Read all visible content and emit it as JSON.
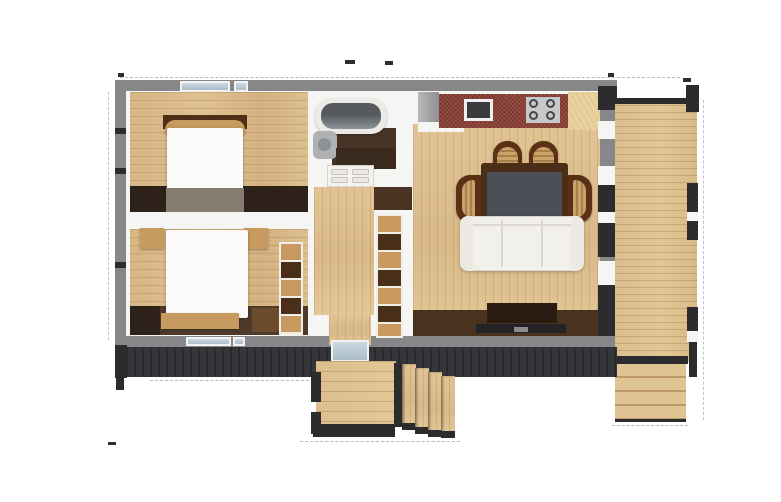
{
  "scene": {
    "type": "3d-floor-plan-render",
    "background": "#ffffff",
    "text_visible": false,
    "annotations": {
      "dimension_tick_marks": true,
      "tick_text_legible": false
    }
  },
  "palette": {
    "wall_gray": "#87878a",
    "wall_dark": "#2c2c2f",
    "siding_dark": "#34363a",
    "glass_blue": "#a9bcc9",
    "brick_red": "#8c4136",
    "shelf_wood": "#c89a62",
    "shelf_dark": "#4a2f1a",
    "duvet_white": "#fbfaf8",
    "tan_wood": "#c79a5f",
    "tub_rim": "#eceae7",
    "tub_gray": "#56595d",
    "chair_brown": "#5a3115",
    "chair_seat_tan": "#caa36b",
    "sofa_cream": "#f2f0ea",
    "table_gray": "#4c5056",
    "table_brown": "#4a2f16",
    "console_brown": "#2a1c10",
    "tv_black": "#232327",
    "floor_dark_brown": "#4e3a29",
    "floor_deep_brown": "#2e211a",
    "under_bed_gray": "#877c70",
    "wood_light": "#e0c192",
    "wood_deck": "#dcbe8e"
  },
  "rooms": [
    {
      "id": "bedroom-1",
      "furniture": [
        "double-bed",
        "headboard",
        "under-bed-runner"
      ]
    },
    {
      "id": "bedroom-2",
      "furniture": [
        "double-bed",
        "nightstand-left",
        "nightstand-right",
        "foot-bench",
        "open-shelf-unit"
      ]
    },
    {
      "id": "bathroom",
      "furniture": [
        "bathtub",
        "washbasin",
        "vanity",
        "drawer-cabinet"
      ]
    },
    {
      "id": "hallway",
      "furniture": [
        "open-shelf-unit",
        "entry-door"
      ]
    },
    {
      "id": "kitchen-living-room",
      "furniture": [
        "refrigerator",
        "kitchen-counter",
        "sink",
        "cooktop",
        "dining-table",
        "dining-chairs-x4",
        "sofa",
        "tv-console",
        "tv"
      ]
    },
    {
      "id": "side-deck",
      "furniture": [
        "deck-steps",
        "corner-posts"
      ]
    },
    {
      "id": "entry-porch",
      "furniture": [
        "porch-steps",
        "posts"
      ]
    }
  ]
}
